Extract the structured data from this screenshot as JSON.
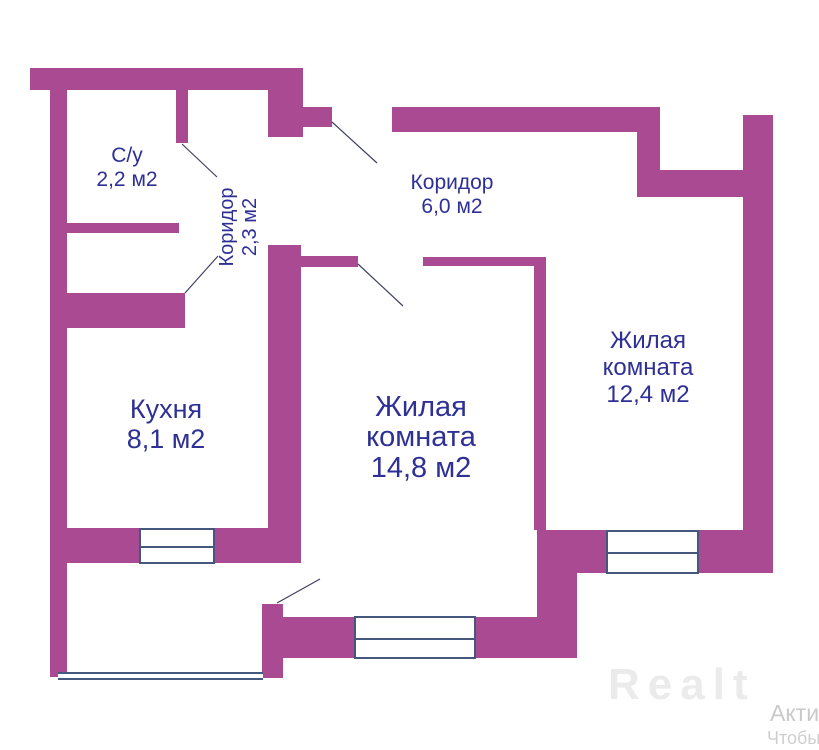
{
  "colors": {
    "wall": "#aa4a92",
    "label": "#2e3096",
    "window_border": "#46577d",
    "door_line": "#3f3f63",
    "watermark": "#ebebeb",
    "watermark_small": "#c9c9c9"
  },
  "plan": {
    "rooms": [
      {
        "name": "С/у",
        "area": "2,2 м2"
      },
      {
        "name": "Коридор",
        "area": "2,3 м2"
      },
      {
        "name": "Коридор",
        "area": "6,0 м2"
      },
      {
        "name": "Кухня",
        "area": "8,1 м2"
      },
      {
        "name": "Жилая",
        "name2": "комната",
        "area": "14,8 м2"
      },
      {
        "name": "Жилая",
        "name2": "комната",
        "area": "12,4 м2"
      }
    ]
  },
  "watermark": {
    "logo": "Realt",
    "caption_line1": "Акти",
    "caption_line2": "Чтобы"
  }
}
